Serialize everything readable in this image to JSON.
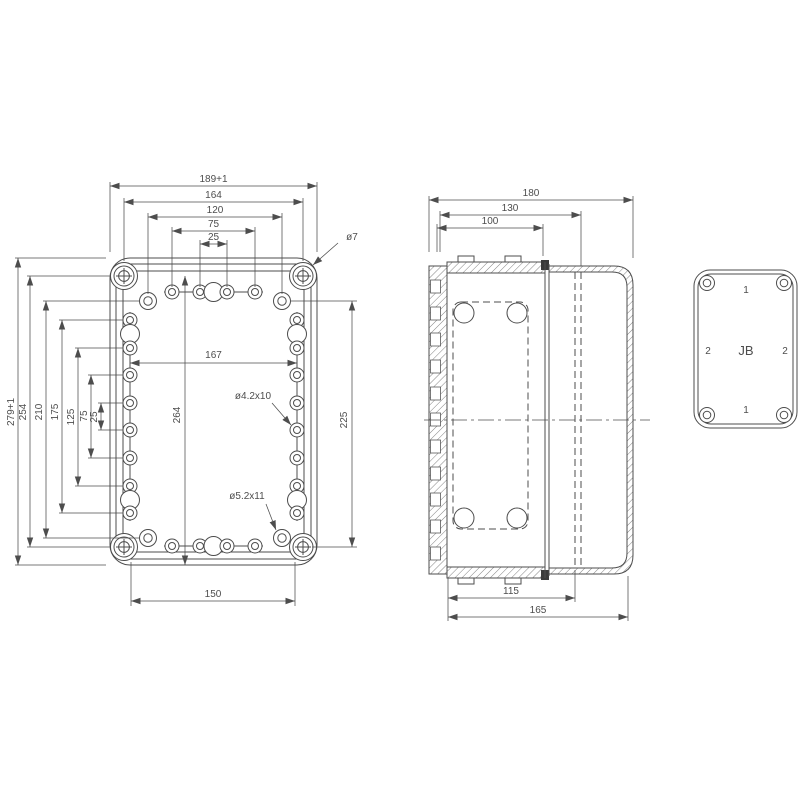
{
  "drawing_title": "junction-box-dimension-drawing",
  "colors": {
    "background": "#ffffff",
    "line": "#4d4d4d",
    "seal": "#3a3a3a"
  },
  "front_view": {
    "dims_horizontal_top": [
      "189+1",
      "164",
      "120",
      "75",
      "25"
    ],
    "dims_vertical_left": [
      "279+1",
      "254",
      "210",
      "175",
      "125",
      "75",
      "25"
    ],
    "dim_inner_width": "167",
    "dim_inner_height": "264",
    "dim_right_height": "225",
    "dim_bottom_width": "150",
    "callout_corner_hole": "ø7",
    "callout_screw_hole": "ø4.2x10",
    "callout_mount_hole": "ø5.2x11"
  },
  "side_view": {
    "dims_top": [
      "180",
      "130",
      "100"
    ],
    "dims_bottom": [
      "115",
      "165"
    ]
  },
  "face_view": {
    "label_center": "JB",
    "label_top": "1",
    "label_bottom": "1",
    "label_left": "2",
    "label_right": "2"
  }
}
